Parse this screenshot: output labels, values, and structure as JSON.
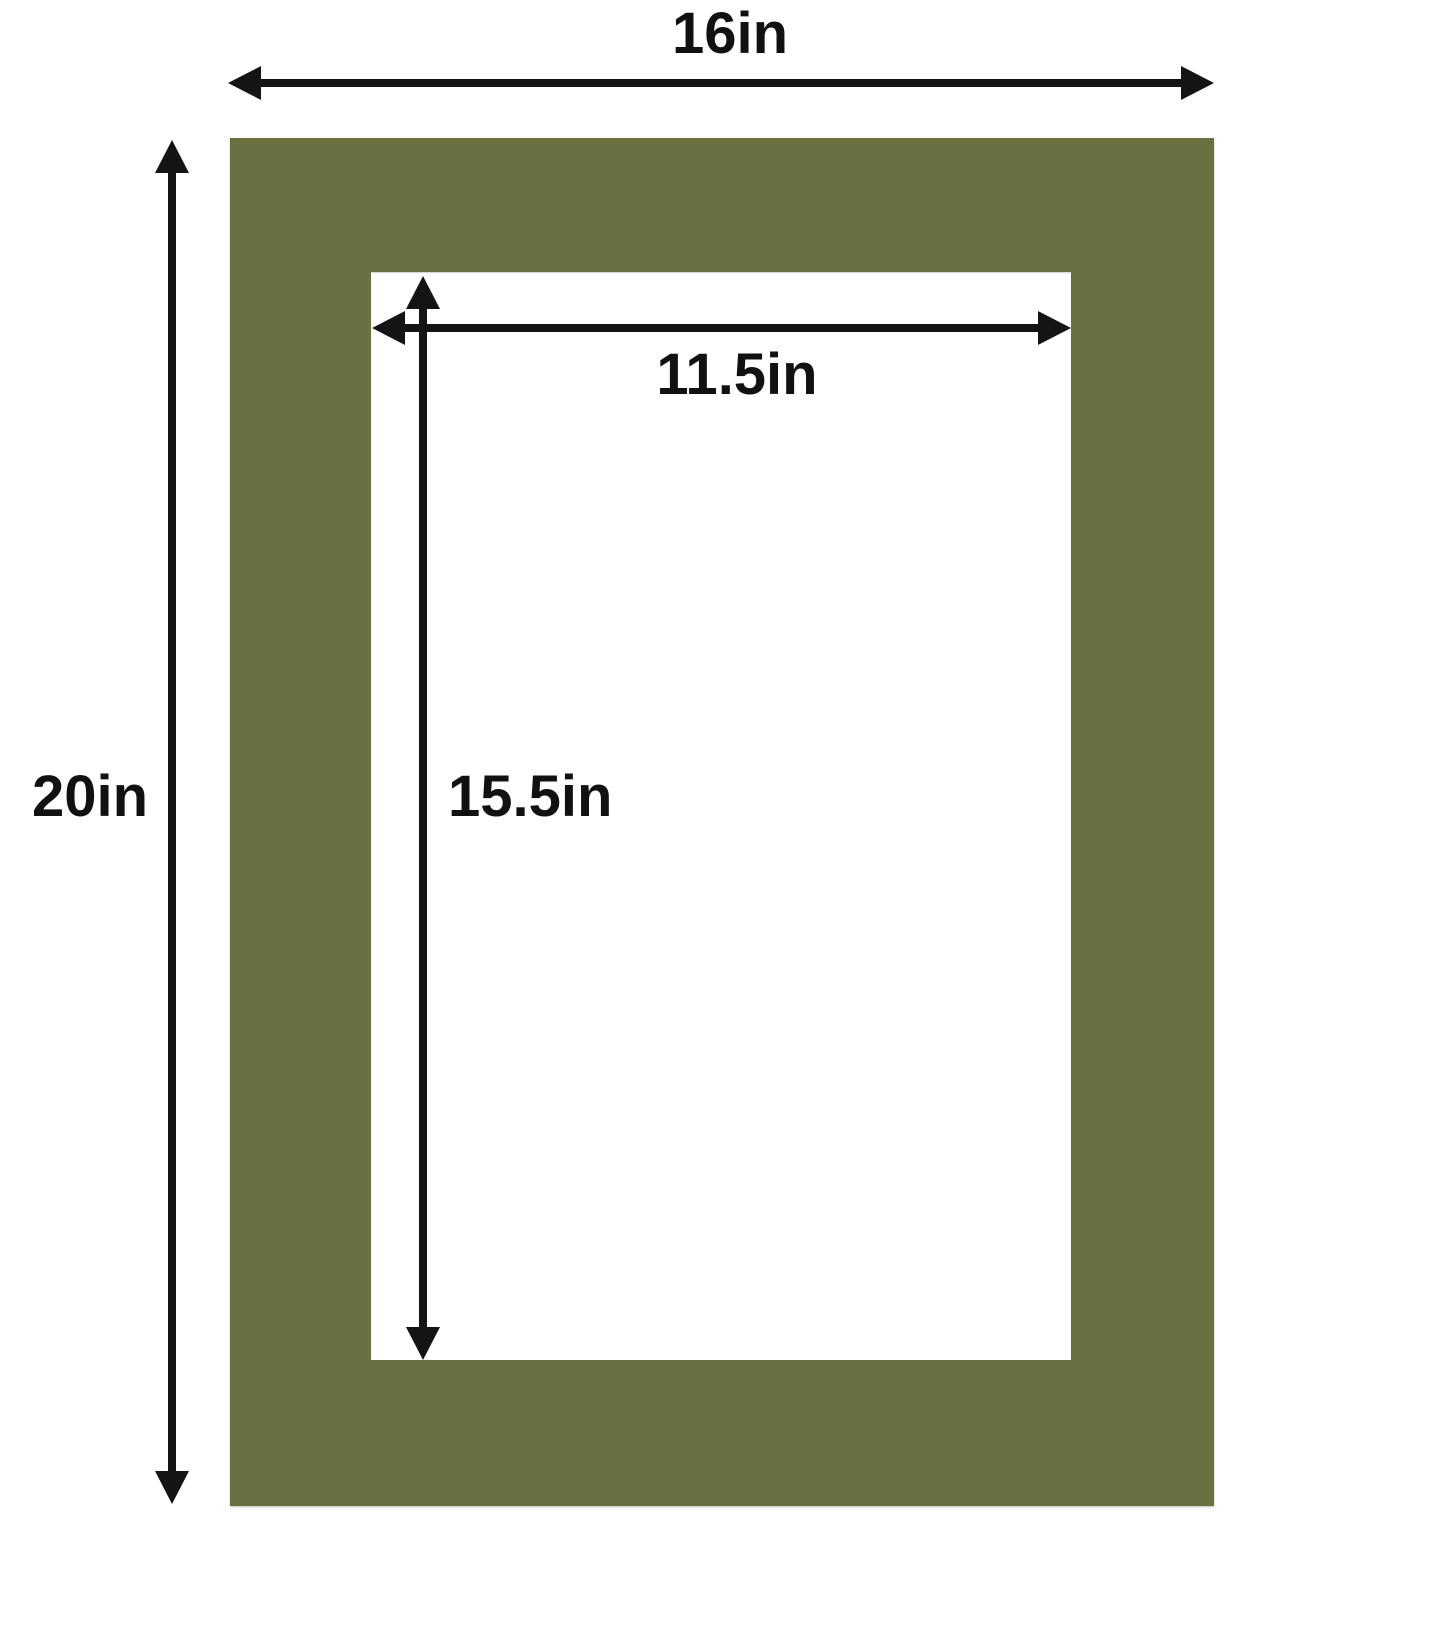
{
  "colors": {
    "mat": "#6b7041",
    "opening": "#ffffff",
    "arrow": "#141414",
    "text": "#111111",
    "background": "#ffffff"
  },
  "labels": {
    "outer_width": "16in",
    "outer_height": "20in",
    "opening_width": "11.5in",
    "opening_height": "15.5in"
  }
}
